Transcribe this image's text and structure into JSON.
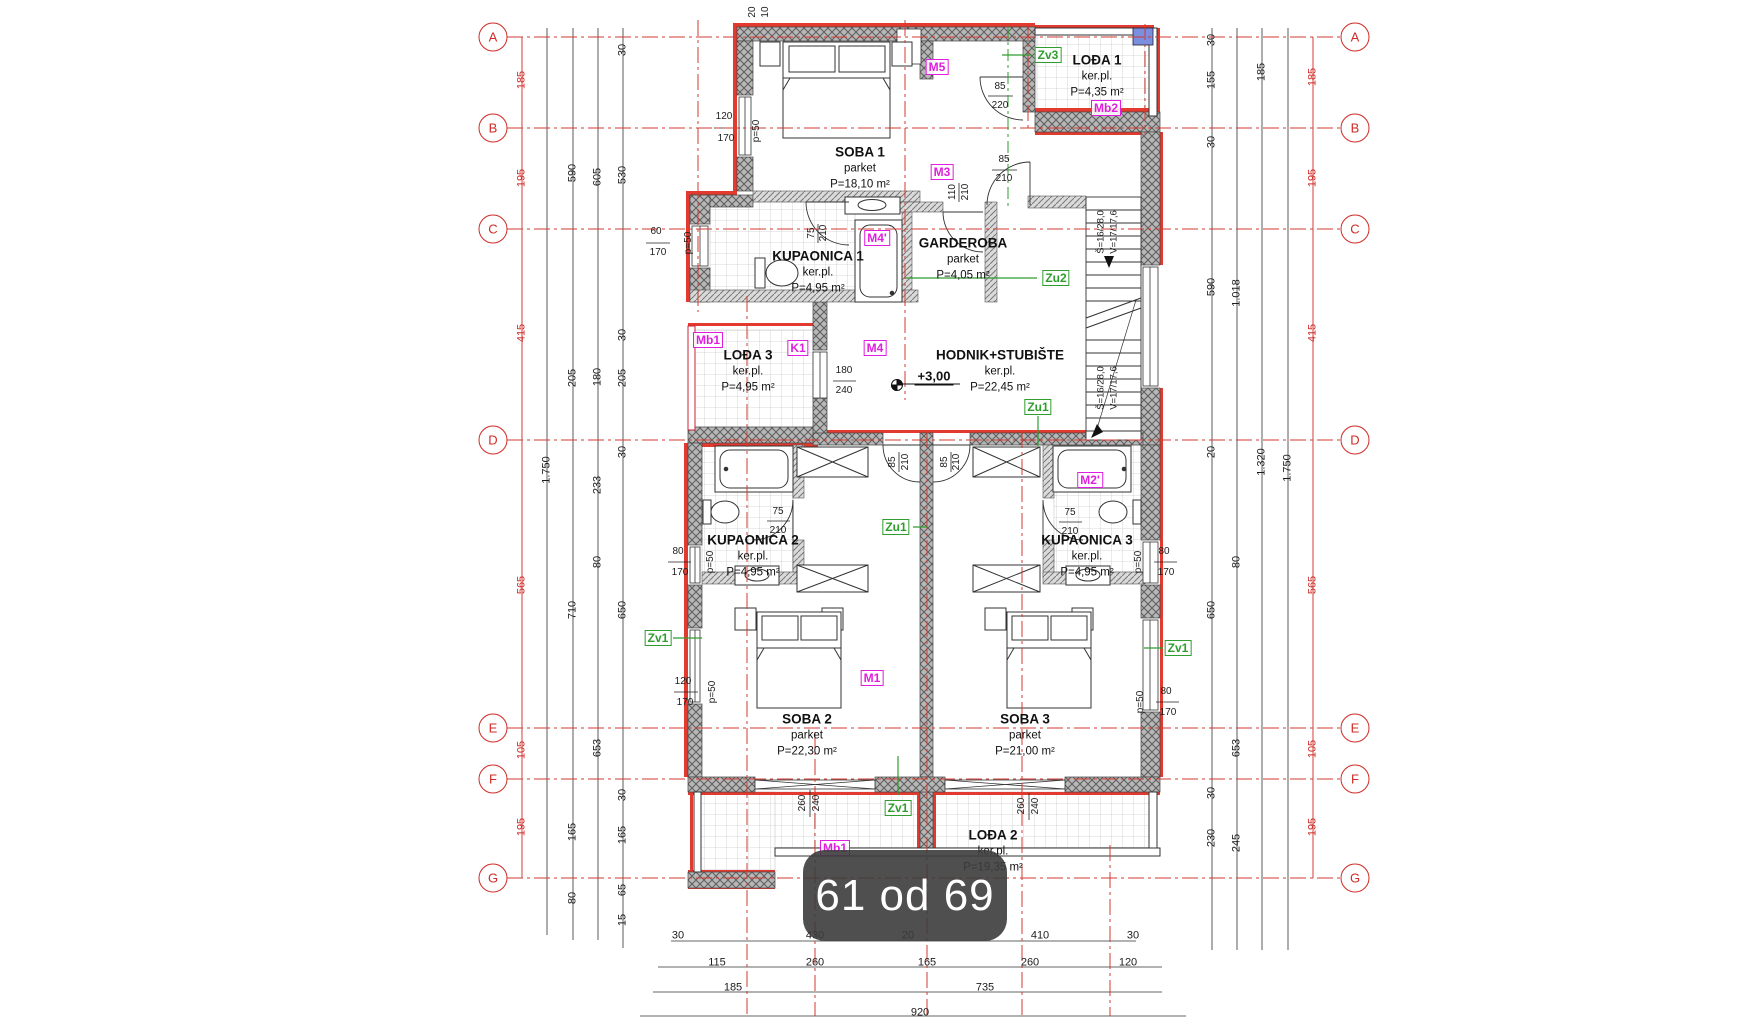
{
  "viewer": {
    "page_indicator": "61 od 69"
  },
  "plan": {
    "grid_axes": {
      "letters": [
        "A",
        "B",
        "C",
        "D",
        "E",
        "F",
        "G"
      ],
      "ys": [
        37,
        128,
        229,
        440,
        728,
        779,
        878
      ],
      "left_cx": 493,
      "right_cx": 1355
    },
    "rooms": [
      {
        "name": "SOBA 1",
        "floor": "parket",
        "area": "P=18,10 m²",
        "x": 860,
        "y": 152
      },
      {
        "name": "LOĐA 1",
        "floor": "ker.pl.",
        "area": "P=4,35 m²",
        "x": 1097,
        "y": 60
      },
      {
        "name": "KUPAONICA 1",
        "floor": "ker.pl.",
        "area": "P=4,95 m²",
        "x": 818,
        "y": 256
      },
      {
        "name": "GARDEROBA",
        "floor": "parket",
        "area": "P=4,05 m²",
        "x": 963,
        "y": 243
      },
      {
        "name": "LOĐA 3",
        "floor": "ker.pl.",
        "area": "P=4,95 m²",
        "x": 748,
        "y": 355
      },
      {
        "name": "HODNIK+STUBIŠTE",
        "floor": "ker.pl.",
        "area": "P=22,45 m²",
        "x": 1000,
        "y": 355
      },
      {
        "name": "KUPAONICA 2",
        "floor": "ker.pl.",
        "area": "P=4,95 m²",
        "x": 753,
        "y": 540
      },
      {
        "name": "KUPAONICA 3",
        "floor": "ker.pl.",
        "area": "P=4,95 m²",
        "x": 1087,
        "y": 540
      },
      {
        "name": "SOBA 2",
        "floor": "parket",
        "area": "P=22,30 m²",
        "x": 807,
        "y": 719
      },
      {
        "name": "SOBA 3",
        "floor": "parket",
        "area": "P=21,00 m²",
        "x": 1025,
        "y": 719
      },
      {
        "name": "LOĐA 2",
        "floor": "ker.pl.",
        "area": "P=19,35 m²",
        "x": 993,
        "y": 835
      }
    ],
    "ref_tags": [
      {
        "text": "M5",
        "x": 937,
        "y": 67
      },
      {
        "text": "M3",
        "x": 942,
        "y": 172
      },
      {
        "text": "M4'",
        "x": 877,
        "y": 238
      },
      {
        "text": "M4",
        "x": 875,
        "y": 348
      },
      {
        "text": "K1",
        "x": 798,
        "y": 348
      },
      {
        "text": "Mb1",
        "x": 708,
        "y": 340
      },
      {
        "text": "Mb2",
        "x": 1106,
        "y": 108
      },
      {
        "text": "M1",
        "x": 872,
        "y": 678
      },
      {
        "text": "M2'",
        "x": 1090,
        "y": 480
      },
      {
        "text": "Mb1",
        "x": 835,
        "y": 848
      }
    ],
    "green_tags": [
      {
        "text": "Zv3",
        "x": 1048,
        "y": 55
      },
      {
        "text": "Zu2",
        "x": 1056,
        "y": 278
      },
      {
        "text": "Zu1",
        "x": 1038,
        "y": 407
      },
      {
        "text": "Zu1",
        "x": 896,
        "y": 527
      },
      {
        "text": "Zv1",
        "x": 658,
        "y": 638
      },
      {
        "text": "Zv1",
        "x": 1178,
        "y": 648
      },
      {
        "text": "Zv1",
        "x": 898,
        "y": 808
      }
    ],
    "level_mark": {
      "text": "+3,00",
      "x": 934,
      "y": 377
    },
    "stair_notes": [
      {
        "text": "Š=16/28,0",
        "x": 1101,
        "y": 232
      },
      {
        "text": "V=17/17,6",
        "x": 1114,
        "y": 232
      },
      {
        "text": "Š=16/28,0",
        "x": 1101,
        "y": 388
      },
      {
        "text": "V=17/17,6",
        "x": 1114,
        "y": 388
      }
    ],
    "dims": [
      {
        "t": "185",
        "x": 522,
        "y": 80,
        "r": 1,
        "c": 1
      },
      {
        "t": "195",
        "x": 522,
        "y": 178,
        "r": 1,
        "c": 1
      },
      {
        "t": "415",
        "x": 522,
        "y": 333,
        "r": 1,
        "c": 1
      },
      {
        "t": "565",
        "x": 522,
        "y": 585,
        "r": 1,
        "c": 1
      },
      {
        "t": "105",
        "x": 522,
        "y": 750,
        "r": 1,
        "c": 1
      },
      {
        "t": "195",
        "x": 522,
        "y": 827,
        "r": 1,
        "c": 1
      },
      {
        "t": "185",
        "x": 1313,
        "y": 77,
        "r": 1,
        "c": 1
      },
      {
        "t": "195",
        "x": 1313,
        "y": 178,
        "r": 1,
        "c": 1
      },
      {
        "t": "415",
        "x": 1313,
        "y": 333,
        "r": 1,
        "c": 1
      },
      {
        "t": "565",
        "x": 1313,
        "y": 585,
        "r": 1,
        "c": 1
      },
      {
        "t": "105",
        "x": 1313,
        "y": 749,
        "r": 1,
        "c": 1
      },
      {
        "t": "195",
        "x": 1313,
        "y": 827,
        "r": 1,
        "c": 1
      },
      {
        "t": "1.750",
        "x": 547,
        "y": 470,
        "r": 1
      },
      {
        "t": "590",
        "x": 573,
        "y": 173,
        "r": 1
      },
      {
        "t": "205",
        "x": 573,
        "y": 378,
        "r": 1
      },
      {
        "t": "710",
        "x": 573,
        "y": 610,
        "r": 1
      },
      {
        "t": "165",
        "x": 573,
        "y": 832,
        "r": 1
      },
      {
        "t": "80",
        "x": 573,
        "y": 898,
        "r": 1
      },
      {
        "t": "605",
        "x": 598,
        "y": 177,
        "r": 1
      },
      {
        "t": "180",
        "x": 598,
        "y": 377,
        "r": 1
      },
      {
        "t": "233",
        "x": 598,
        "y": 485,
        "r": 1
      },
      {
        "t": "80",
        "x": 598,
        "y": 562,
        "r": 1
      },
      {
        "t": "653",
        "x": 598,
        "y": 748,
        "r": 1
      },
      {
        "t": "30",
        "x": 623,
        "y": 50,
        "r": 1
      },
      {
        "t": "530",
        "x": 623,
        "y": 175,
        "r": 1
      },
      {
        "t": "30",
        "x": 623,
        "y": 335,
        "r": 1
      },
      {
        "t": "205",
        "x": 623,
        "y": 378,
        "r": 1
      },
      {
        "t": "30",
        "x": 623,
        "y": 452,
        "r": 1
      },
      {
        "t": "650",
        "x": 623,
        "y": 610,
        "r": 1
      },
      {
        "t": "30",
        "x": 623,
        "y": 795,
        "r": 1
      },
      {
        "t": "165",
        "x": 623,
        "y": 835,
        "r": 1
      },
      {
        "t": "65",
        "x": 623,
        "y": 890,
        "r": 1
      },
      {
        "t": "15",
        "x": 623,
        "y": 920,
        "r": 1
      },
      {
        "t": "30",
        "x": 1212,
        "y": 40,
        "r": 1
      },
      {
        "t": "155",
        "x": 1212,
        "y": 80,
        "r": 1
      },
      {
        "t": "30",
        "x": 1212,
        "y": 142,
        "r": 1
      },
      {
        "t": "590",
        "x": 1212,
        "y": 287,
        "r": 1
      },
      {
        "t": "20",
        "x": 1212,
        "y": 452,
        "r": 1
      },
      {
        "t": "650",
        "x": 1212,
        "y": 610,
        "r": 1
      },
      {
        "t": "30",
        "x": 1212,
        "y": 793,
        "r": 1
      },
      {
        "t": "230",
        "x": 1212,
        "y": 838,
        "r": 1
      },
      {
        "t": "1.018",
        "x": 1237,
        "y": 293,
        "r": 1
      },
      {
        "t": "80",
        "x": 1237,
        "y": 562,
        "r": 1
      },
      {
        "t": "653",
        "x": 1237,
        "y": 748,
        "r": 1
      },
      {
        "t": "245",
        "x": 1237,
        "y": 843,
        "r": 1
      },
      {
        "t": "185",
        "x": 1262,
        "y": 72,
        "r": 1
      },
      {
        "t": "1.320",
        "x": 1262,
        "y": 462,
        "r": 1
      },
      {
        "t": "1.750",
        "x": 1288,
        "y": 468,
        "r": 1
      },
      {
        "t": "30",
        "x": 678,
        "y": 936
      },
      {
        "t": "430",
        "x": 815,
        "y": 936
      },
      {
        "t": "20",
        "x": 908,
        "y": 936
      },
      {
        "t": "410",
        "x": 1040,
        "y": 936
      },
      {
        "t": "30",
        "x": 1133,
        "y": 936
      },
      {
        "t": "115",
        "x": 717,
        "y": 963
      },
      {
        "t": "260",
        "x": 815,
        "y": 963
      },
      {
        "t": "165",
        "x": 927,
        "y": 963
      },
      {
        "t": "260",
        "x": 1030,
        "y": 963
      },
      {
        "t": "120",
        "x": 1128,
        "y": 963
      },
      {
        "t": "185",
        "x": 733,
        "y": 988
      },
      {
        "t": "735",
        "x": 985,
        "y": 988
      },
      {
        "t": "920",
        "x": 920,
        "y": 1013
      },
      {
        "t": "20",
        "x": 753,
        "y": 12,
        "r": 1,
        "s": 1
      },
      {
        "t": "10",
        "x": 766,
        "y": 12,
        "r": 1,
        "s": 1
      },
      {
        "t": "120",
        "x": 724,
        "y": 117,
        "s": 1
      },
      {
        "t": "170",
        "x": 726,
        "y": 139,
        "s": 1
      },
      {
        "t": "p=50",
        "x": 757,
        "y": 131,
        "r": 1,
        "s": 1
      },
      {
        "t": "60",
        "x": 656,
        "y": 232,
        "s": 1
      },
      {
        "t": "170",
        "x": 658,
        "y": 253,
        "s": 1
      },
      {
        "t": "p=50",
        "x": 689,
        "y": 243,
        "r": 1,
        "s": 1
      },
      {
        "t": "85",
        "x": 1000,
        "y": 87,
        "s": 1
      },
      {
        "t": "220",
        "x": 1000,
        "y": 106,
        "s": 1
      },
      {
        "t": "85",
        "x": 1004,
        "y": 160,
        "s": 1
      },
      {
        "t": "210",
        "x": 1004,
        "y": 179,
        "s": 1
      },
      {
        "t": "110",
        "x": 953,
        "y": 192,
        "r": 1,
        "s": 1
      },
      {
        "t": "210",
        "x": 966,
        "y": 192,
        "r": 1,
        "s": 1
      },
      {
        "t": "75",
        "x": 812,
        "y": 233,
        "r": 1,
        "s": 1
      },
      {
        "t": "210",
        "x": 824,
        "y": 233,
        "r": 1,
        "s": 1
      },
      {
        "t": "180",
        "x": 844,
        "y": 371,
        "s": 1
      },
      {
        "t": "240",
        "x": 844,
        "y": 391,
        "s": 1
      },
      {
        "t": "75",
        "x": 778,
        "y": 512,
        "s": 1
      },
      {
        "t": "210",
        "x": 778,
        "y": 531,
        "s": 1
      },
      {
        "t": "80",
        "x": 678,
        "y": 552,
        "s": 1
      },
      {
        "t": "170",
        "x": 680,
        "y": 573,
        "s": 1
      },
      {
        "t": "p=50",
        "x": 711,
        "y": 562,
        "r": 1,
        "s": 1
      },
      {
        "t": "85",
        "x": 893,
        "y": 462,
        "r": 1,
        "s": 1
      },
      {
        "t": "210",
        "x": 906,
        "y": 462,
        "r": 1,
        "s": 1
      },
      {
        "t": "85",
        "x": 945,
        "y": 462,
        "r": 1,
        "s": 1
      },
      {
        "t": "210",
        "x": 957,
        "y": 462,
        "r": 1,
        "s": 1
      },
      {
        "t": "75",
        "x": 1070,
        "y": 513,
        "s": 1
      },
      {
        "t": "210",
        "x": 1070,
        "y": 532,
        "s": 1
      },
      {
        "t": "80",
        "x": 1164,
        "y": 552,
        "s": 1
      },
      {
        "t": "170",
        "x": 1166,
        "y": 573,
        "s": 1
      },
      {
        "t": "p=50",
        "x": 1139,
        "y": 562,
        "r": 1,
        "s": 1
      },
      {
        "t": "120",
        "x": 683,
        "y": 682,
        "s": 1
      },
      {
        "t": "170",
        "x": 685,
        "y": 703,
        "s": 1
      },
      {
        "t": "p=50",
        "x": 713,
        "y": 692,
        "r": 1,
        "s": 1
      },
      {
        "t": "80",
        "x": 1166,
        "y": 692,
        "s": 1
      },
      {
        "t": "170",
        "x": 1168,
        "y": 713,
        "s": 1
      },
      {
        "t": "p=50",
        "x": 1141,
        "y": 702,
        "r": 1,
        "s": 1
      },
      {
        "t": "260",
        "x": 803,
        "y": 803,
        "r": 1,
        "s": 1
      },
      {
        "t": "240",
        "x": 817,
        "y": 803,
        "r": 1,
        "s": 1
      },
      {
        "t": "260",
        "x": 1022,
        "y": 806,
        "r": 1,
        "s": 1
      },
      {
        "t": "240",
        "x": 1036,
        "y": 806,
        "r": 1,
        "s": 1
      }
    ]
  }
}
